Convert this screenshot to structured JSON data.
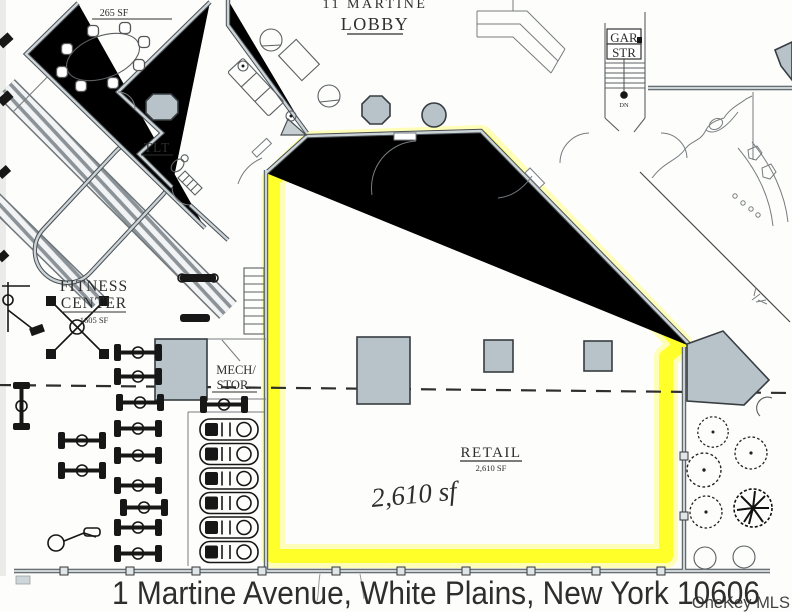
{
  "plan": {
    "lobby_title": "11 MARTINE",
    "lobby_subtitle": "LOBBY",
    "conference_sf": "265 SF",
    "garage_stair_line1": "GAR",
    "garage_stair_line2": "STR",
    "stair_direction": "DN",
    "toilet": "TLT",
    "fitness_line1": "FITNESS",
    "fitness_line2": "CENTER",
    "fitness_sf": "1605 SF",
    "mech_line1": "MECH/",
    "mech_line2": "STOR.",
    "retail": "RETAIL",
    "retail_sf": "2,610 SF",
    "handwritten_note": "2,610 sf"
  },
  "caption": {
    "address": "1 Martine Avenue, White Plains, New York 10606",
    "color": "#dc4a3c"
  },
  "watermark": {
    "label": "OneKey MLS",
    "color": "#c6c6c6"
  },
  "colors": {
    "highlight": "#ffff21",
    "highlight_glow": "#ffff66",
    "plan_gray": "#b8c2c9"
  }
}
